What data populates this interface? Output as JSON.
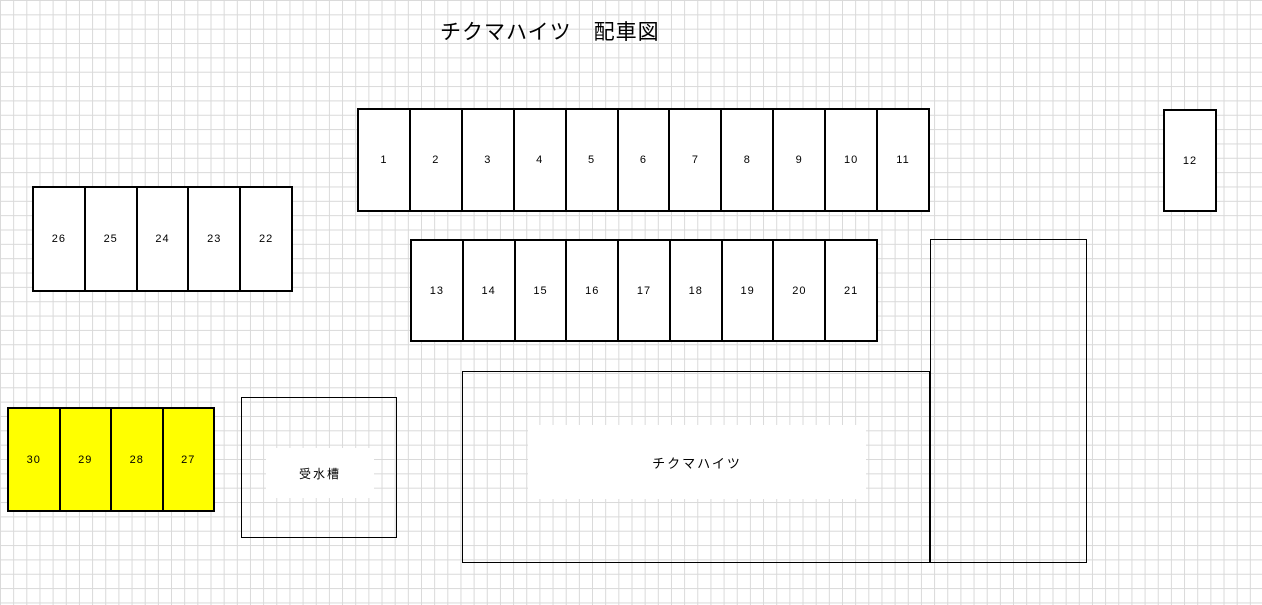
{
  "title": "チクマハイツ　配車図",
  "parking": {
    "row_top_spaces": [
      "1",
      "2",
      "3",
      "4",
      "5",
      "6",
      "7",
      "8",
      "9",
      "10",
      "11"
    ],
    "space_12": "12",
    "row_left_spaces": [
      "26",
      "25",
      "24",
      "23",
      "22"
    ],
    "row_middle_spaces": [
      "13",
      "14",
      "15",
      "16",
      "17",
      "18",
      "19",
      "20",
      "21"
    ],
    "row_highlighted_spaces": [
      "30",
      "29",
      "28",
      "27"
    ]
  },
  "structures": {
    "water_tank_label": "受水槽",
    "building_label": "チクマハイツ"
  },
  "colors": {
    "highlight_fill": "#ffff00",
    "space_fill": "#ffffff",
    "outline": "#000000",
    "grid_line": "#d9d9d9"
  }
}
